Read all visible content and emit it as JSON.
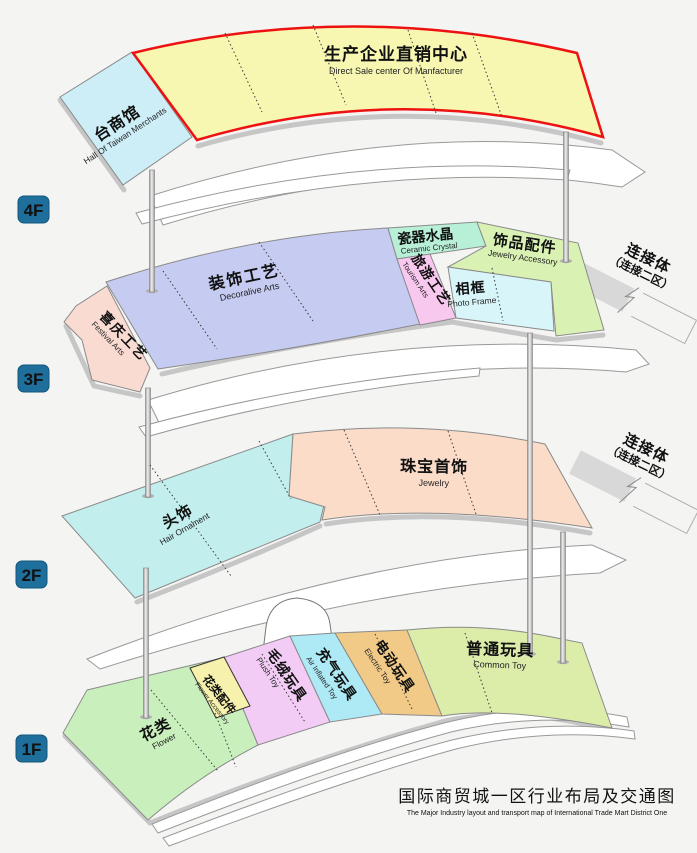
{
  "colors": {
    "background": "#f4f4f3",
    "taiwan": "#cdeef7",
    "manufacturer": "#f7f7b2",
    "manufacturer_border": "#ee1111",
    "festival": "#fadbd2",
    "decorative": "#c6cbf2",
    "ceramic": "#b7f0d6",
    "tourism": "#f9c8ef",
    "photo_frame": "#d8f6fa",
    "jewelry_accessory": "#d9f2b4",
    "hair": "#c2eeed",
    "jewelry": "#fbdcc9",
    "flower": "#c9efbc",
    "flower_accessory": "#f6f1ac",
    "plush": "#f3ccf5",
    "inflated": "#aeeaf6",
    "electric": "#f2ca88",
    "common": "#dcedaa",
    "badge": "#1f6f9c",
    "badge_border": "#11567c",
    "badge_text": "#d7dbde",
    "connector_band": "#d8d8d8",
    "title": "#4c4c4c",
    "title_en": "#b3b3b3"
  },
  "badges": {
    "f4": "4F",
    "f3": "3F",
    "f2": "2F",
    "f1": "1F"
  },
  "regions": {
    "taiwan": {
      "zh": "台商馆",
      "en": "Hall Of Taiwan Merchants"
    },
    "manufacturer": {
      "zh": "生产企业直销中心",
      "en": "Direct Sale center Of Manfacturer"
    },
    "festival": {
      "zh": "喜庆工艺",
      "en": "Festival Arts"
    },
    "decorative": {
      "zh": "装饰工艺",
      "en": "Decoralive Arts"
    },
    "ceramic": {
      "zh": "瓷器水晶",
      "en": "Ceramic Crystal"
    },
    "tourism": {
      "zh": "旅游工艺",
      "en": "Tourism Arts"
    },
    "photo_frame": {
      "zh": "相框",
      "en": "Photo Frame"
    },
    "jewelry_accessory": {
      "zh": "饰品配件",
      "en": "Jewelry Accessory"
    },
    "hair": {
      "zh": "头饰",
      "en": "Hair Ornament"
    },
    "jewelry": {
      "zh": "珠宝首饰",
      "en": "Jewelry"
    },
    "flower": {
      "zh": "花类",
      "en": "Flower"
    },
    "flower_accessory": {
      "zh": "花类配件",
      "en": "Flower Accessory"
    },
    "plush": {
      "zh": "毛绒玩具",
      "en": "Plush Toy"
    },
    "inflated": {
      "zh": "充气玩具",
      "en": "Air Inflated Toy"
    },
    "electric": {
      "zh": "电动玩具",
      "en": "Electric Toy"
    },
    "common": {
      "zh": "普通玩具",
      "en": "Common Toy"
    }
  },
  "connector": {
    "line1": "连接体",
    "line2": "（连接二区）"
  },
  "title": {
    "zh": "国际商贸城一区行业布局及交通图",
    "en": "The Major Industry layout and transport map of International Trade Mart District One"
  }
}
